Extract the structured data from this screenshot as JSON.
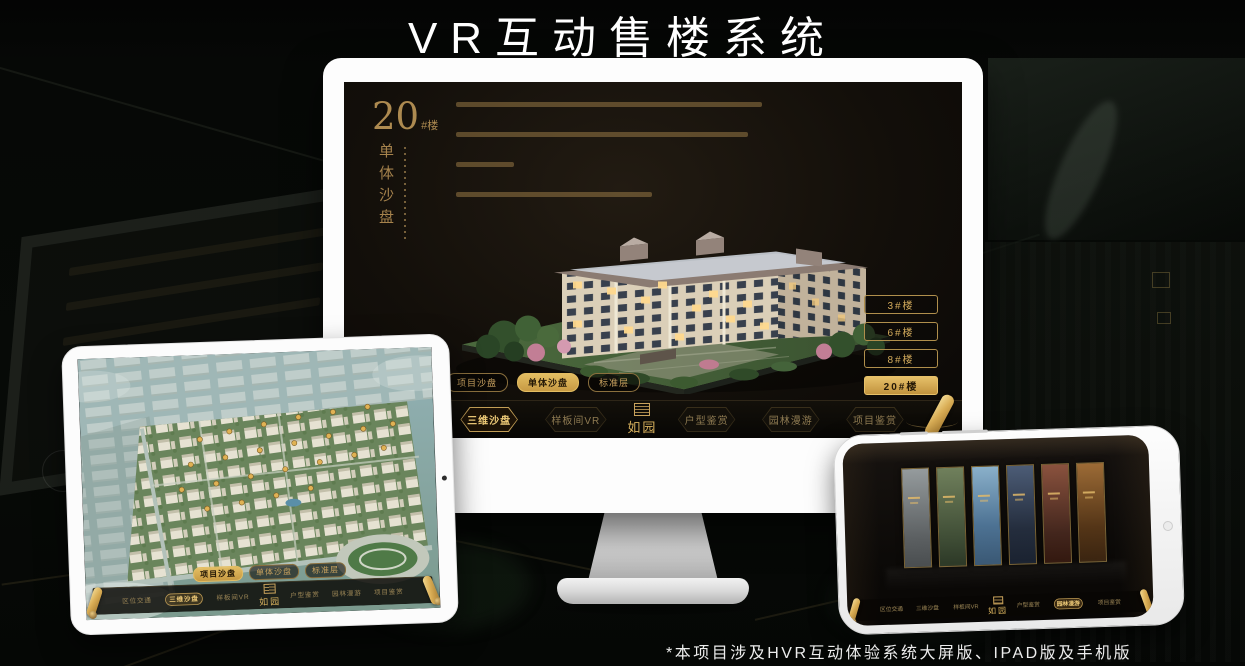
{
  "page": {
    "title": "VR互动售楼系统",
    "footnote": "*本项目涉及HVR互动体验系统大屏版、IPAD版及手机版"
  },
  "brand": {
    "logo": "如园"
  },
  "colors": {
    "accent_gold": "#C9A25F",
    "selected_gold": "#DDB457",
    "screen_bg": "#14100B"
  },
  "view_tabs": [
    {
      "label": "项目沙盘"
    },
    {
      "label": "单体沙盘"
    },
    {
      "label": "标准层"
    }
  ],
  "nav_items": [
    {
      "label": "区位交通"
    },
    {
      "label": "三维沙盘"
    },
    {
      "label": "样板间VR"
    },
    {
      "label": "户型鉴赏"
    },
    {
      "label": "园林漫游"
    },
    {
      "label": "项目鉴赏"
    }
  ],
  "desktop": {
    "heading_number": "20",
    "heading_suffix": "#楼",
    "heading_vertical": "单体沙盘",
    "selected_tab": "单体沙盘",
    "selected_nav": "三维沙盘",
    "floor_buttons": [
      {
        "label": "3#楼",
        "selected": false
      },
      {
        "label": "6#楼",
        "selected": false
      },
      {
        "label": "8#楼",
        "selected": false
      },
      {
        "label": "20#楼",
        "selected": true
      }
    ]
  },
  "ipad": {
    "selected_tab": "项目沙盘",
    "selected_nav": "三维沙盘"
  },
  "phone": {
    "selected_nav": "园林漫游"
  }
}
